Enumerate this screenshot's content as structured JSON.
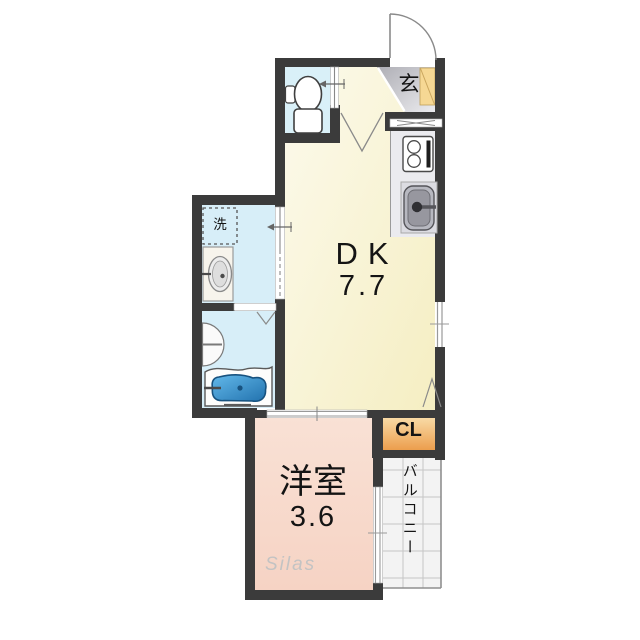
{
  "plan": {
    "entrance": {
      "label": "玄"
    },
    "dk": {
      "label": "DK",
      "area": "7.7"
    },
    "western_room": {
      "label": "洋室",
      "area": "3.6"
    },
    "closet": {
      "label": "CL"
    },
    "balcony": {
      "label": "バルコニー"
    },
    "laundry": {
      "label": "洗"
    },
    "watermark": "Silas",
    "colors": {
      "wall": "#3b3b3b",
      "dk_room": "#f8f3d2",
      "western_room": "#f8dbce",
      "wet_rooms": "#d7eef8",
      "closet_gradient_top": "#f8daa5",
      "closet_gradient_bottom": "#ec9e4d",
      "entrance_gray": "#b6b6bc",
      "shoe_cabinet": "#f6d894",
      "bathtub_blue": "#3f9ad2",
      "balcony_tile": "#f3f3f3"
    }
  }
}
